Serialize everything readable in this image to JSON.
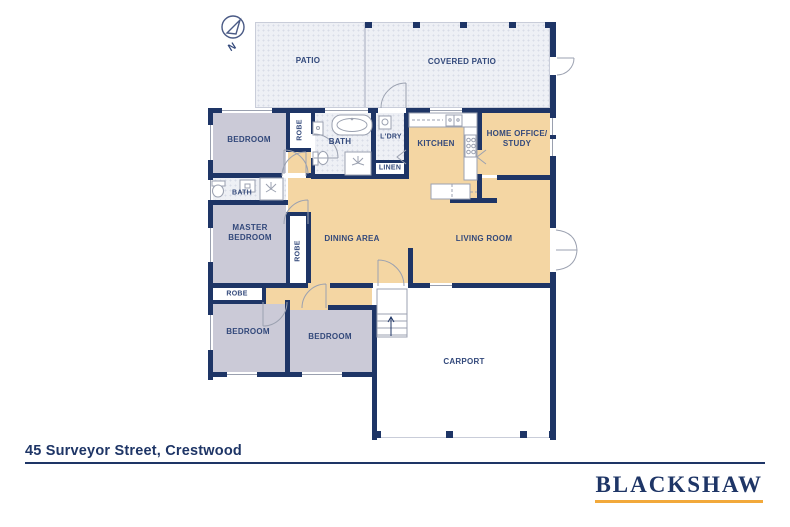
{
  "footer": {
    "address": "45 Surveyor Street, Crestwood",
    "brand": "BLACKSHAW"
  },
  "compass": {
    "label": "N"
  },
  "colors": {
    "navy": "#1E3566",
    "tan": "#F4D6A3",
    "lavender": "#CBCAD7",
    "floor_light": "#EEF0F5",
    "gold": "#F2A93B",
    "label": "#33497B",
    "fixture_line": "#9BA1B0"
  },
  "rooms": {
    "patio": "PATIO",
    "covered_patio": "COVERED PATIO",
    "bedroom_top": "BEDROOM",
    "robe_top": "ROBE",
    "bath_main": "BATH",
    "laundry": "L'DRY",
    "linen": "LINEN",
    "kitchen": "KITCHEN",
    "home_office": "HOME OFFICE/\nSTUDY",
    "bath_ensuite": "BATH",
    "master_bedroom": "MASTER\nBEDROOM",
    "robe_master": "ROBE",
    "dining": "DINING AREA",
    "living": "LIVING ROOM",
    "robe_box": "ROBE",
    "bedroom_sw": "BEDROOM",
    "bedroom_s": "BEDROOM",
    "carport": "CARPORT"
  }
}
